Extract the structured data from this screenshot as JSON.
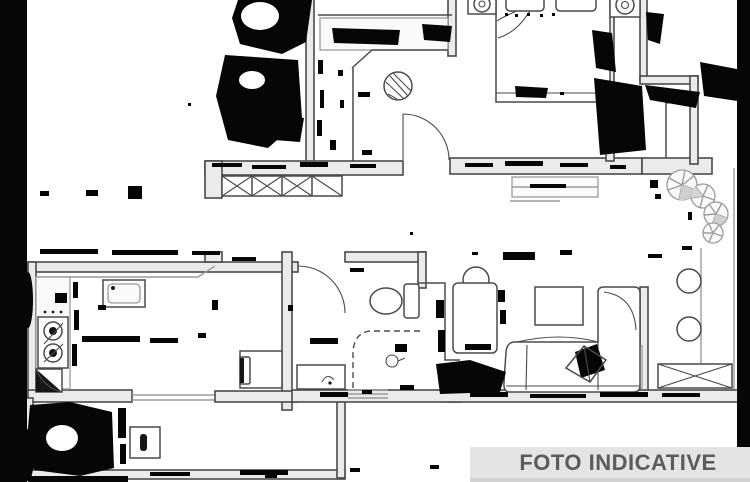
{
  "banner": {
    "label": "FOTO INDICATIVE"
  },
  "colors": {
    "background": "#ffffff",
    "plan_line": "#4a4a4a",
    "plan_line_light": "#9b9b9b",
    "wall_fill": "#ebebeb",
    "artifact": "#060606",
    "banner_bg": "#e4e4e4",
    "banner_bottom": "#d2d2d2",
    "banner_text": "#5b5b5b"
  },
  "plan": {
    "type": "apartment-floor-plan",
    "style": "degraded black-and-white scan with compression artifacts",
    "watermark": "FOTO INDICATIVE",
    "rooms": [
      {
        "name": "entry-hall",
        "fixtures": [
          "built-in-wardrobe",
          "round-hatched-table",
          "entry-door-arc"
        ]
      },
      {
        "name": "bedroom",
        "fixtures": [
          "double-bed",
          "two-pillows",
          "nightstand-lamp-left",
          "nightstand-lamp-right",
          "closet"
        ]
      },
      {
        "name": "hall-wardrobe",
        "fixtures": [
          "x-braced-wardrobe-4-cells"
        ]
      },
      {
        "name": "kitchen",
        "fixtures": [
          "counter",
          "sink",
          "stove-two-burners",
          "corner-cabinet",
          "desk-with-chair"
        ]
      },
      {
        "name": "bathroom",
        "fixtures": [
          "toilet",
          "shower-dashed-enclosure",
          "vanity-sink",
          "door-arc"
        ]
      },
      {
        "name": "living-room",
        "fixtures": [
          "l-shaped-sofa",
          "throw-pillow",
          "coffee-table",
          "armchair",
          "round-side-table"
        ]
      },
      {
        "name": "terrace",
        "fixtures": [
          "plants",
          "two-round-stools",
          "x-braced-table",
          "railing"
        ]
      },
      {
        "name": "lower-balcony",
        "fixtures": [
          "ac-unit"
        ]
      }
    ]
  }
}
